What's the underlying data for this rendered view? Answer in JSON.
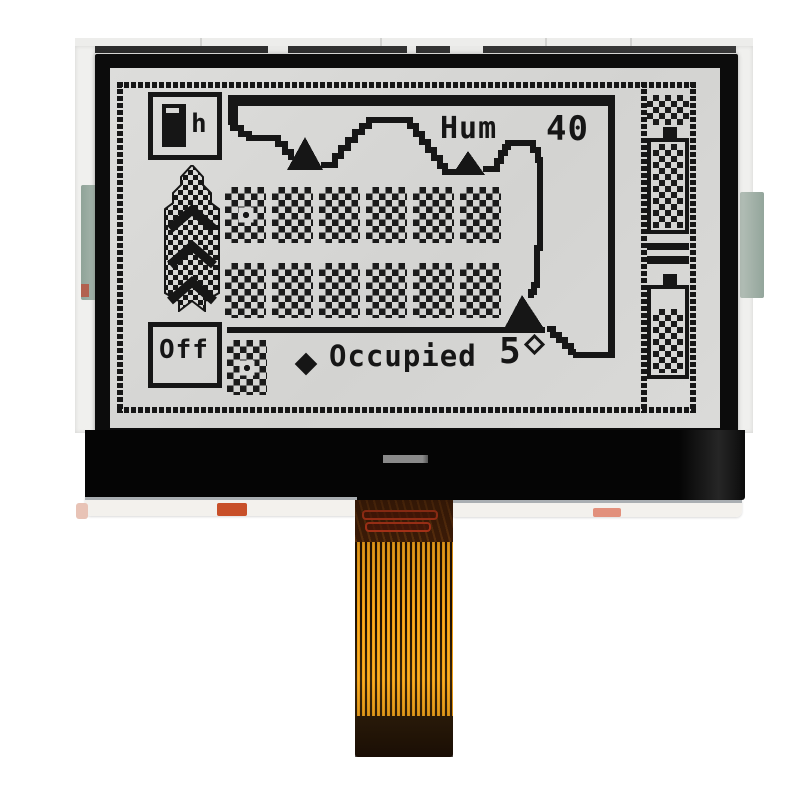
{
  "module": {
    "kind": "monochrome graphic COG LCD module photo",
    "screen": {
      "top_left_icon": {
        "name": "battery-with-h",
        "label": "h"
      },
      "bottom_left_icon": {
        "label": "Off"
      },
      "left_indicator": {
        "name": "stacked-up-chevrons"
      },
      "humidity": {
        "label": "Hum",
        "value": "40"
      },
      "status": {
        "marker": "filled-diamond",
        "label": "Occupied"
      },
      "temperature": {
        "value": "5",
        "unit": "°"
      },
      "dither_grid": {
        "rows": 2,
        "columns": 6
      },
      "right_indicators": [
        "dither-block",
        "battery-full",
        "equals-bars",
        "battery-partial"
      ],
      "map": {
        "markers": 3,
        "style": "stepped coastline outline with top bar"
      },
      "colors": {
        "pixel": "#161616",
        "background": "#d7d7d5"
      }
    },
    "hardware": {
      "bezel_color": "#0c0c0c",
      "glass_strip_color": "#050505",
      "connector_dash_color": "#8a8a8a",
      "flex_cable_orange": "#f09c14",
      "flex_trace_red": "#d23c1e",
      "pcb_tab_green": "#9fb0a6",
      "solder_pad_orange": "#c8502a"
    }
  }
}
